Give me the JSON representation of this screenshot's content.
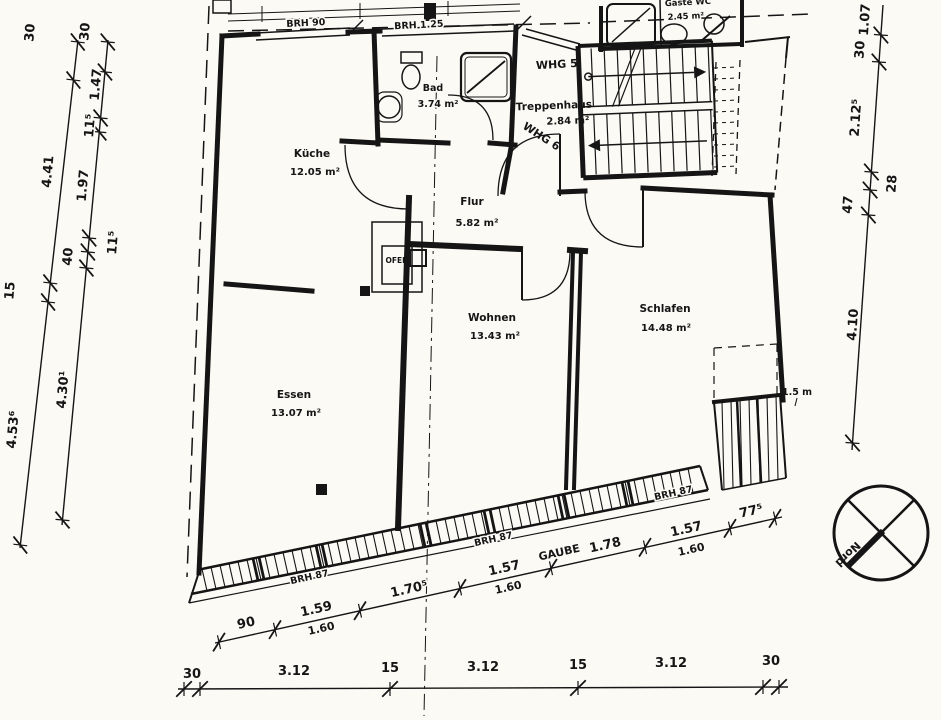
{
  "drawing": {
    "rooms": {
      "kueche": {
        "name": "Küche",
        "area": "12.05 m²"
      },
      "bad": {
        "name": "Bad",
        "area": "3.74 m²"
      },
      "flur": {
        "name": "Flur",
        "area": "5.82 m²"
      },
      "wohnen": {
        "name": "Wohnen",
        "area": "13.43 m²"
      },
      "schlafen": {
        "name": "Schlafen",
        "area": "14.48 m²"
      },
      "essen": {
        "name": "Essen",
        "area": "13.07 m²"
      },
      "treppenhaus": {
        "name": "Treppenhaus",
        "area": "2.84 m²"
      },
      "gaeste_wc": {
        "name": "Gäste WC",
        "area": "2.45 m²"
      }
    },
    "apartments": {
      "whg5": "WHG 5",
      "whg6": "WHG 6"
    },
    "annotations": {
      "brh90": "BRH 90",
      "brh125": "BRH 1.25",
      "brh87": "BRH 87",
      "ofen": "OFEN",
      "gaube": "GAUBE",
      "clearance": "1.5 m",
      "north": "Nord"
    },
    "dimensions": {
      "left_outer": [
        "30",
        "4.41",
        "15",
        "4.53⁶"
      ],
      "left_inner": [
        "30",
        "1.47",
        "11⁵",
        "1.97",
        "11⁵",
        "40",
        "4.30¹"
      ],
      "right_side": [
        "1.07",
        "30",
        "2.12⁵",
        "28",
        "47",
        "4.10"
      ],
      "facade": [
        "90",
        "1.59",
        "1.60",
        "1.70⁵",
        "1.57",
        "1.60",
        "1.78",
        "1.57",
        "1.60",
        "77⁵"
      ],
      "overall": [
        "30",
        "3.12",
        "15",
        "3.12",
        "15",
        "3.12",
        "30"
      ]
    }
  }
}
